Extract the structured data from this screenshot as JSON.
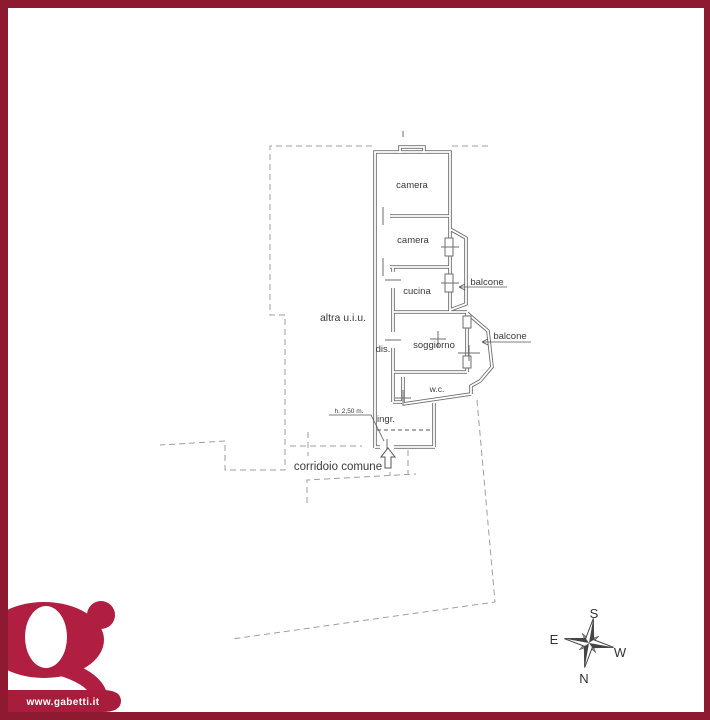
{
  "page": {
    "background": "#ffffff",
    "frame_color": "#8e1a32",
    "type_note": "scanned real-estate floor plan"
  },
  "floor_plan": {
    "room_labels": {
      "camera1": "camera",
      "camera2": "camera",
      "cucina": "cucina",
      "soggiorno": "soggiorno",
      "wc": "w.c.",
      "dis": "dis.",
      "ingr": "ingr."
    },
    "annotations": {
      "balcone1": "balcone",
      "balcone2": "balcone",
      "altra_uiu": "altra u.i.u.",
      "corridoio_comune": "corridoio comune",
      "height_note": "h. 2,50 m."
    },
    "line_colors": {
      "walls": "#6e6e6e",
      "boundary_dashed": "#9f9f9f",
      "text": "#3a3a3a"
    }
  },
  "compass": {
    "top": "S",
    "left": "E",
    "right": "W",
    "bottom": "N"
  },
  "brand": {
    "website": "www.gabetti.it",
    "logo_color": "#b01e41",
    "banner_color": "#a91d3c"
  }
}
